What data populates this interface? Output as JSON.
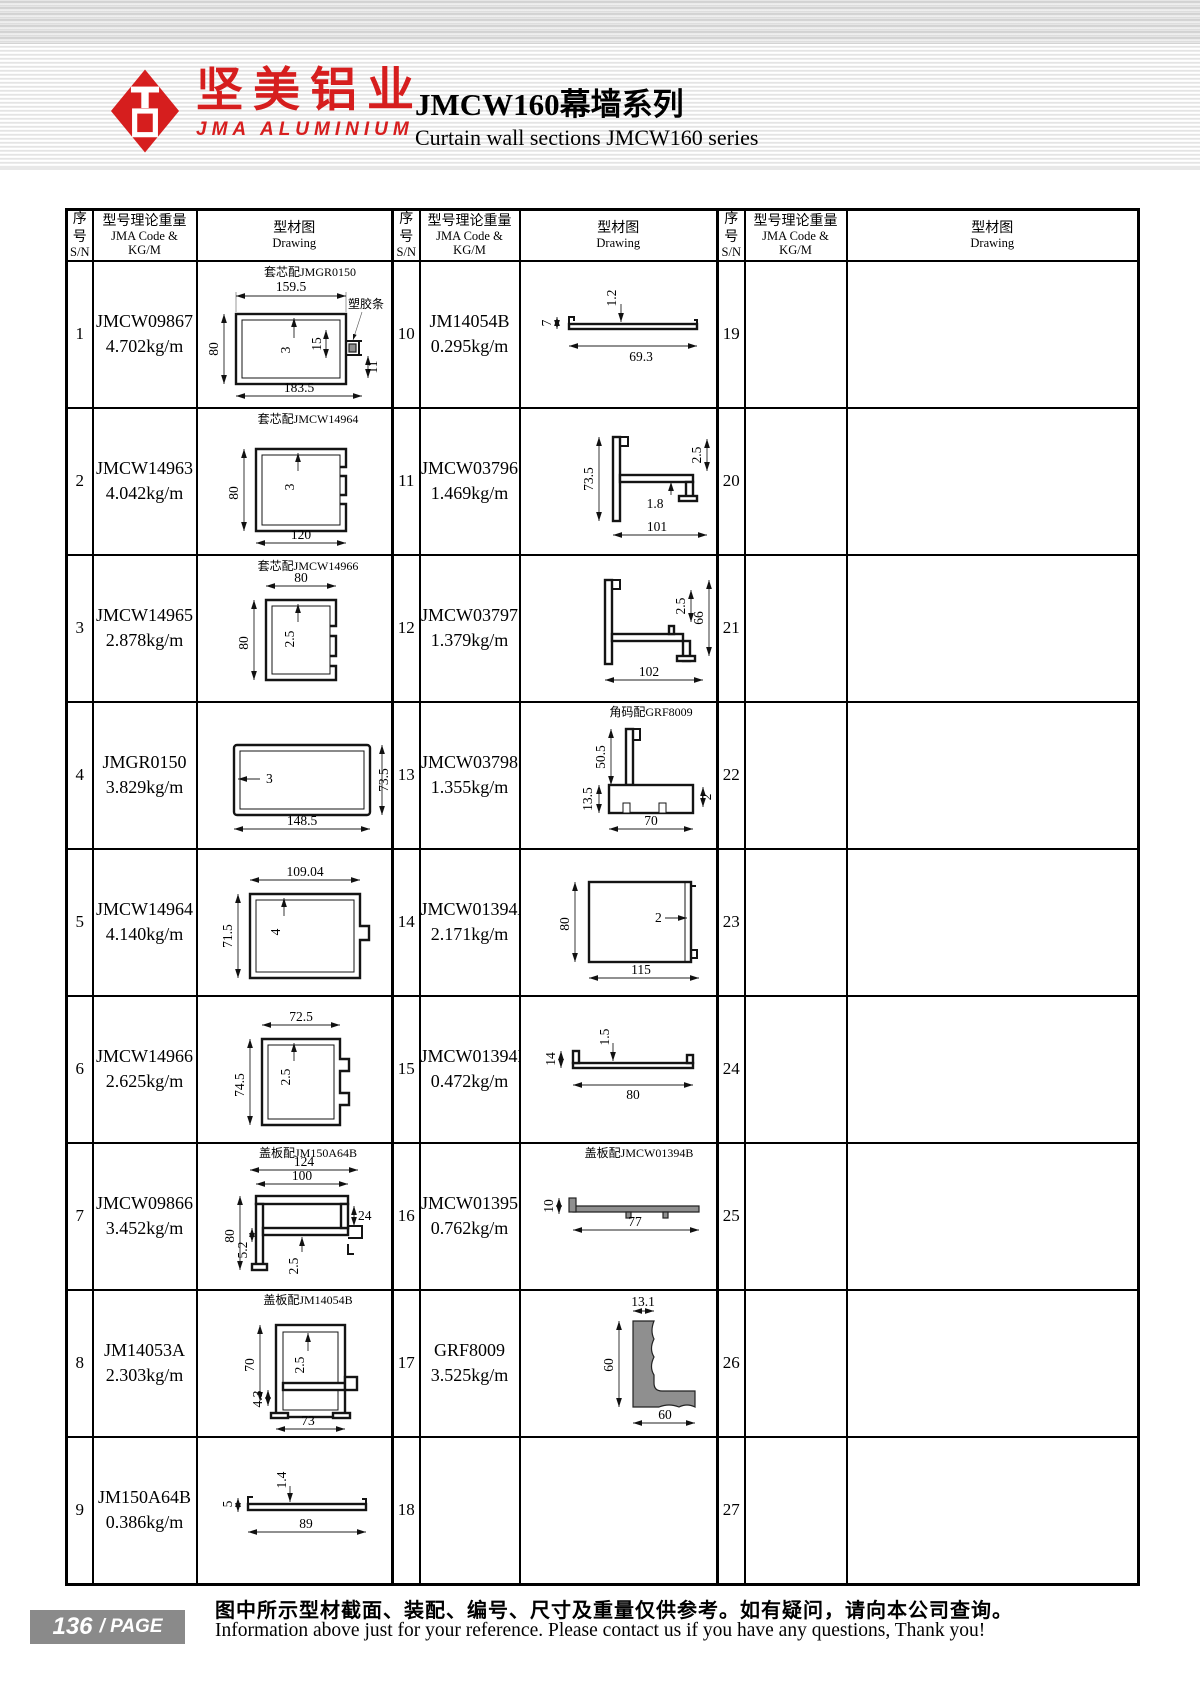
{
  "brand": {
    "name_zh": "坚美铝业",
    "name_en": "JMA ALUMINIUM"
  },
  "title": {
    "zh": "JMCW160幕墙系列",
    "en": "Curtain wall sections JMCW160 series"
  },
  "columns": {
    "sn_zh": "序号",
    "sn_en": "S/N",
    "code_zh": "型号理论重量",
    "code_en": "JMA Code & KG/M",
    "draw_zh": "型材图",
    "draw_en": "Drawing"
  },
  "rows_left": [
    {
      "sn": "1",
      "code": "JMCW09867",
      "weight": "4.702kg/m",
      "note": "套芯配JMGR0150",
      "strip": "塑胶条",
      "dims": [
        "159.5",
        "80",
        "3",
        "15",
        "11",
        "183.5"
      ]
    },
    {
      "sn": "2",
      "code": "JMCW14963",
      "weight": "4.042kg/m",
      "note": "套芯配JMCW14964",
      "dims": [
        "80",
        "3",
        "120"
      ]
    },
    {
      "sn": "3",
      "code": "JMCW14965",
      "weight": "2.878kg/m",
      "note": "套芯配JMCW14966",
      "dims": [
        "80",
        "80",
        "2.5"
      ]
    },
    {
      "sn": "4",
      "code": "JMGR0150",
      "weight": "3.829kg/m",
      "dims": [
        "3",
        "73.5",
        "148.5"
      ]
    },
    {
      "sn": "5",
      "code": "JMCW14964",
      "weight": "4.140kg/m",
      "dims": [
        "109.04",
        "71.5",
        "4"
      ]
    },
    {
      "sn": "6",
      "code": "JMCW14966",
      "weight": "2.625kg/m",
      "dims": [
        "72.5",
        "74.5",
        "2.5"
      ]
    },
    {
      "sn": "7",
      "code": "JMCW09866",
      "weight": "3.452kg/m",
      "note": "盖板配JM150A64B",
      "dims": [
        "124",
        "100",
        "80",
        "5.2",
        "24",
        "2.5"
      ]
    },
    {
      "sn": "8",
      "code": "JM14053A",
      "weight": "2.303kg/m",
      "note": "盖板配JM14054B",
      "dims": [
        "70",
        "2.5",
        "4.3",
        "73"
      ]
    },
    {
      "sn": "9",
      "code": "JM150A64B",
      "weight": "0.386kg/m",
      "dims": [
        "1.4",
        "5",
        "89"
      ]
    }
  ],
  "rows_mid": [
    {
      "sn": "10",
      "code": "JM14054B",
      "weight": "0.295kg/m",
      "dims": [
        "7",
        "1.2",
        "69.3"
      ]
    },
    {
      "sn": "11",
      "code": "JMCW03796",
      "weight": "1.469kg/m",
      "dims": [
        "73.5",
        "2.5",
        "1.8",
        "101"
      ]
    },
    {
      "sn": "12",
      "code": "JMCW03797",
      "weight": "1.379kg/m",
      "dims": [
        "2.5",
        "66",
        "102"
      ]
    },
    {
      "sn": "13",
      "code": "JMCW03798",
      "weight": "1.355kg/m",
      "note": "角码配GRF8009",
      "dims": [
        "50.5",
        "13.5",
        "2",
        "70"
      ]
    },
    {
      "sn": "14",
      "code": "JMCW01394A",
      "weight": "2.171kg/m",
      "dims": [
        "80",
        "2",
        "115"
      ]
    },
    {
      "sn": "15",
      "code": "JMCW01394B",
      "weight": "0.472kg/m",
      "dims": [
        "14",
        "1.5",
        "80"
      ]
    },
    {
      "sn": "16",
      "code": "JMCW01395",
      "weight": "0.762kg/m",
      "note": "盖板配JMCW01394B",
      "dims": [
        "10",
        "77"
      ]
    },
    {
      "sn": "17",
      "code": "GRF8009",
      "weight": "3.525kg/m",
      "dims": [
        "13.1",
        "60",
        "60"
      ]
    },
    {
      "sn": "18"
    }
  ],
  "rows_right": [
    {
      "sn": "19"
    },
    {
      "sn": "20"
    },
    {
      "sn": "21"
    },
    {
      "sn": "22"
    },
    {
      "sn": "23"
    },
    {
      "sn": "24"
    },
    {
      "sn": "25"
    },
    {
      "sn": "26"
    },
    {
      "sn": "27"
    }
  ],
  "footer": {
    "page": "136",
    "page_label": "/ PAGE",
    "note_zh": "图中所示型材截面、装配、编号、尺寸及重量仅供参考。如有疑问，请向本公司查询。",
    "note_en": "Information above just for your reference. Please contact us if you have any questions, Thank you!"
  }
}
